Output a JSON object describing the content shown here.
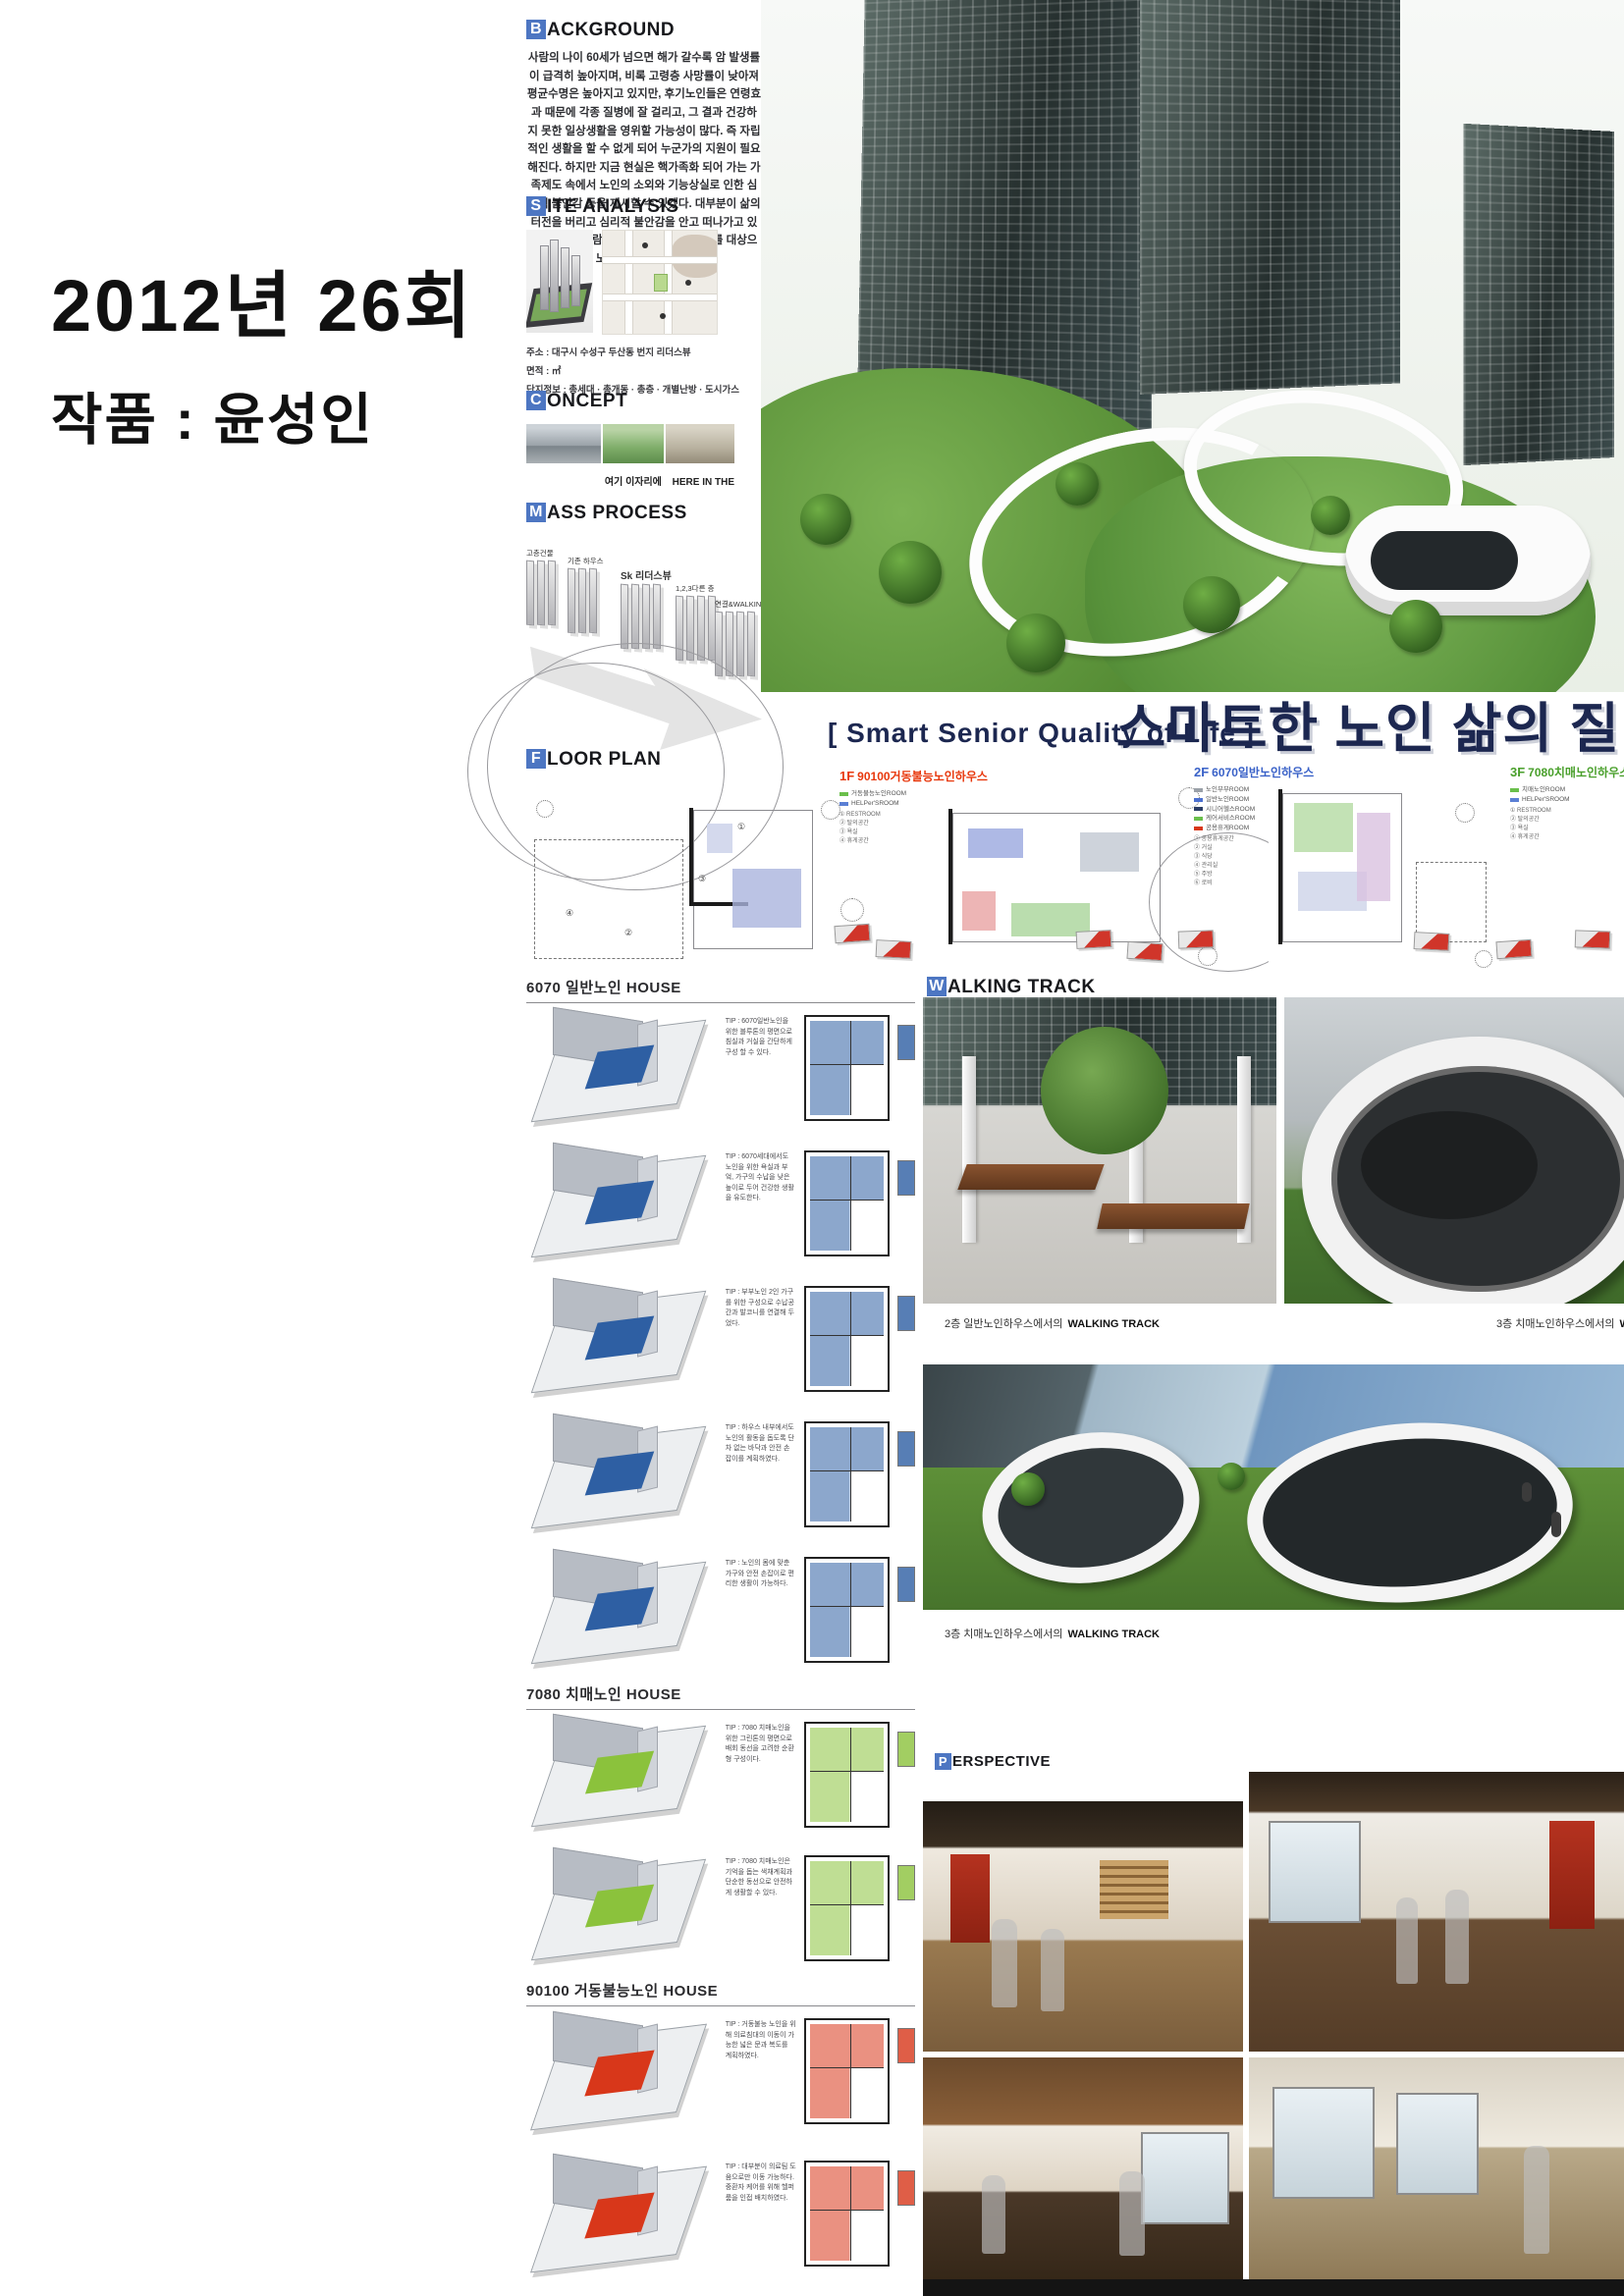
{
  "colors": {
    "headline_navy": "#1c2750",
    "header_initial_bg": "#4d76c2",
    "red": "#e8380d",
    "blue": "#3a62c8",
    "green": "#4aa02c"
  },
  "left_panel": {
    "year_line": "2012년 26회",
    "work_line": "작품 : 윤성인"
  },
  "sections": {
    "background": {
      "initial": "B",
      "rest": "ACKGROUND",
      "text": "사람의 나이 60세가 넘으면 해가 갈수록 암 발생률이 급격히 높아지며, 비록 고령층 사망률이 낮아져 평균수명은 높아지고 있지만, 후기노인들은 연령효과 때문에 각종 질병에 잘 걸리고, 그 결과 건강하지 못한 일상생활을 영위할 가능성이 많다. 즉 자립적인 생활을 할 수 없게 되어 누군가의 지원이 필요해진다. 하지만 지금 현실은 핵가족화 되어 가는 가족제도 속에서 노인의 소외와 기능상실로 인한 심리적 불안감 등을 제시할 수 있겠다. 대부분이 삶의 터전을 버리고 심리적 불안감을 안고 떠나가고 있다. 그래서 사람들이 주거하는 주거단지를 대상으로 노인하우스를 제안한다."
    },
    "site_analysis": {
      "initial": "S",
      "rest": "ITE ANALYSIS",
      "info_lines": [
        "주소 : 대구시 수성구 두산동 번지 리더스뷰",
        "면적 : ㎡",
        "단지정보 : 총세대 · 총개동 · 총층 · 개별난방 · 도시가스"
      ]
    },
    "concept": {
      "initial": "C",
      "rest": "ONCEPT",
      "caption_ko": "여기 이자리에",
      "caption_en": "HERE IN THE"
    },
    "mass_process": {
      "initial": "M",
      "rest": "ASS PROCESS",
      "steps": [
        {
          "label": "고층건물"
        },
        {
          "label": "기존 하우스"
        },
        {
          "label": "Sk 리더스뷰"
        },
        {
          "label": "1,2,3다른 층"
        },
        {
          "label": "연결&WALKING TRACK"
        }
      ]
    },
    "headline": {
      "en": "[ Smart Senior Quality of Life ]",
      "ko": "스마트한 노인 삶의 질"
    },
    "floor_plan": {
      "initial": "F",
      "rest": "LOOR PLAN",
      "marks": [
        "①",
        "②",
        "③",
        "④"
      ],
      "plans": [
        {
          "tag": "1F",
          "title": "90100거동불능노인하우스",
          "color": "#e8380d",
          "legend": [
            {
              "color": "#6abf4b",
              "label": "거동불능노인ROOM"
            },
            {
              "color": "#5b7fd4",
              "label": "HELPer'SROOM"
            }
          ],
          "notes": [
            "① RESTROOM",
            "② 탈의공간",
            "③ 욕실",
            "④ 휴게공간"
          ]
        },
        {
          "tag": "2F",
          "title": "6070일반노인하우스",
          "color": "#3a62c8",
          "legend": [
            {
              "color": "#9aa0a8",
              "label": "노인부부ROOM"
            },
            {
              "color": "#4a6fd0",
              "label": "일반노인ROOM"
            },
            {
              "color": "#2b3d66",
              "label": "시니어헬스ROOM"
            },
            {
              "color": "#6abf4b",
              "label": "케어서비스ROOM"
            },
            {
              "color": "#d8371a",
              "label": "공용휴게ROOM"
            }
          ],
          "notes": [
            "① 공용휴게공간",
            "② 거실",
            "③ 식당",
            "④ 관리실",
            "⑤ 주방",
            "⑥ 로비"
          ]
        },
        {
          "tag": "3F",
          "title": "7080치매노인하우스",
          "color": "#4aa02c",
          "legend": [
            {
              "color": "#6abf4b",
              "label": "치매노인ROOM"
            },
            {
              "color": "#5b7fd4",
              "label": "HELPer'SROOM"
            }
          ],
          "notes": [
            "① RESTROOM",
            "② 탈의공간",
            "③ 욕실",
            "④ 휴게공간"
          ]
        }
      ]
    },
    "walking_track": {
      "initial": "W",
      "rest": "ALKING TRACK",
      "captions": [
        {
          "ko": "2층 일반노인하우스에서의",
          "en": "WALKING TRACK"
        },
        {
          "ko": "3층 치매노인하우스에서의",
          "en": "WALKING TRACK"
        },
        {
          "ko": "3층 치매노인하우스에서의",
          "en": "WALKING TRACK"
        }
      ]
    },
    "perspective": {
      "initial": "P",
      "rest": "ERSPECTIVE"
    }
  },
  "houses": [
    {
      "title": "6070 일반노인 HOUSE",
      "accent": "#2e5fa3",
      "rows": [
        {
          "tip": "TIP : 6070일반노인을 위한 블루톤의 평면으로 침실과 거실을 간단하게 구성 할 수 있다."
        },
        {
          "tip": "TIP : 6070세대에서도 노인을 위한 욕실과 부엌, 가구의 수납을 낮은 높이로 두어 건강한 생활을 유도한다."
        },
        {
          "tip": "TIP : 부부노인 2인 가구를 위한 구성으로 수납공간과 발코니를 연결해 두었다."
        },
        {
          "tip": "TIP : 하우스 내부에서도 노인의 활동을 돕도록 단차 없는 바닥과 안전 손잡이를 계획하였다."
        },
        {
          "tip": "TIP : 노인의 몸에 맞춘 가구와 안전 손잡이로 편리한 생활이 가능하다."
        }
      ]
    },
    {
      "title": "7080 치매노인 HOUSE",
      "accent": "#8bc23c",
      "rows": [
        {
          "tip": "TIP : 7080 치매노인을 위한 그린톤의 평면으로 배회 동선을 고려한 순환형 구성이다."
        },
        {
          "tip": "TIP : 7080 치매노인은 기억을 돕는 색채계획과 단순한 동선으로 안전하게 생활할 수 있다."
        }
      ]
    },
    {
      "title": "90100 거동불능노인 HOUSE",
      "accent": "#d8371a",
      "rows": [
        {
          "tip": "TIP : 거동불능 노인을 위해 의료침대의 이동이 가능한 넓은 문과 복도를 계획하였다."
        },
        {
          "tip": "TIP : 대부분이 의료팀 도움으로만 이동 가능하다. 중환자 케어를 위해 헬퍼룸을 인접 배치하였다."
        }
      ]
    }
  ]
}
